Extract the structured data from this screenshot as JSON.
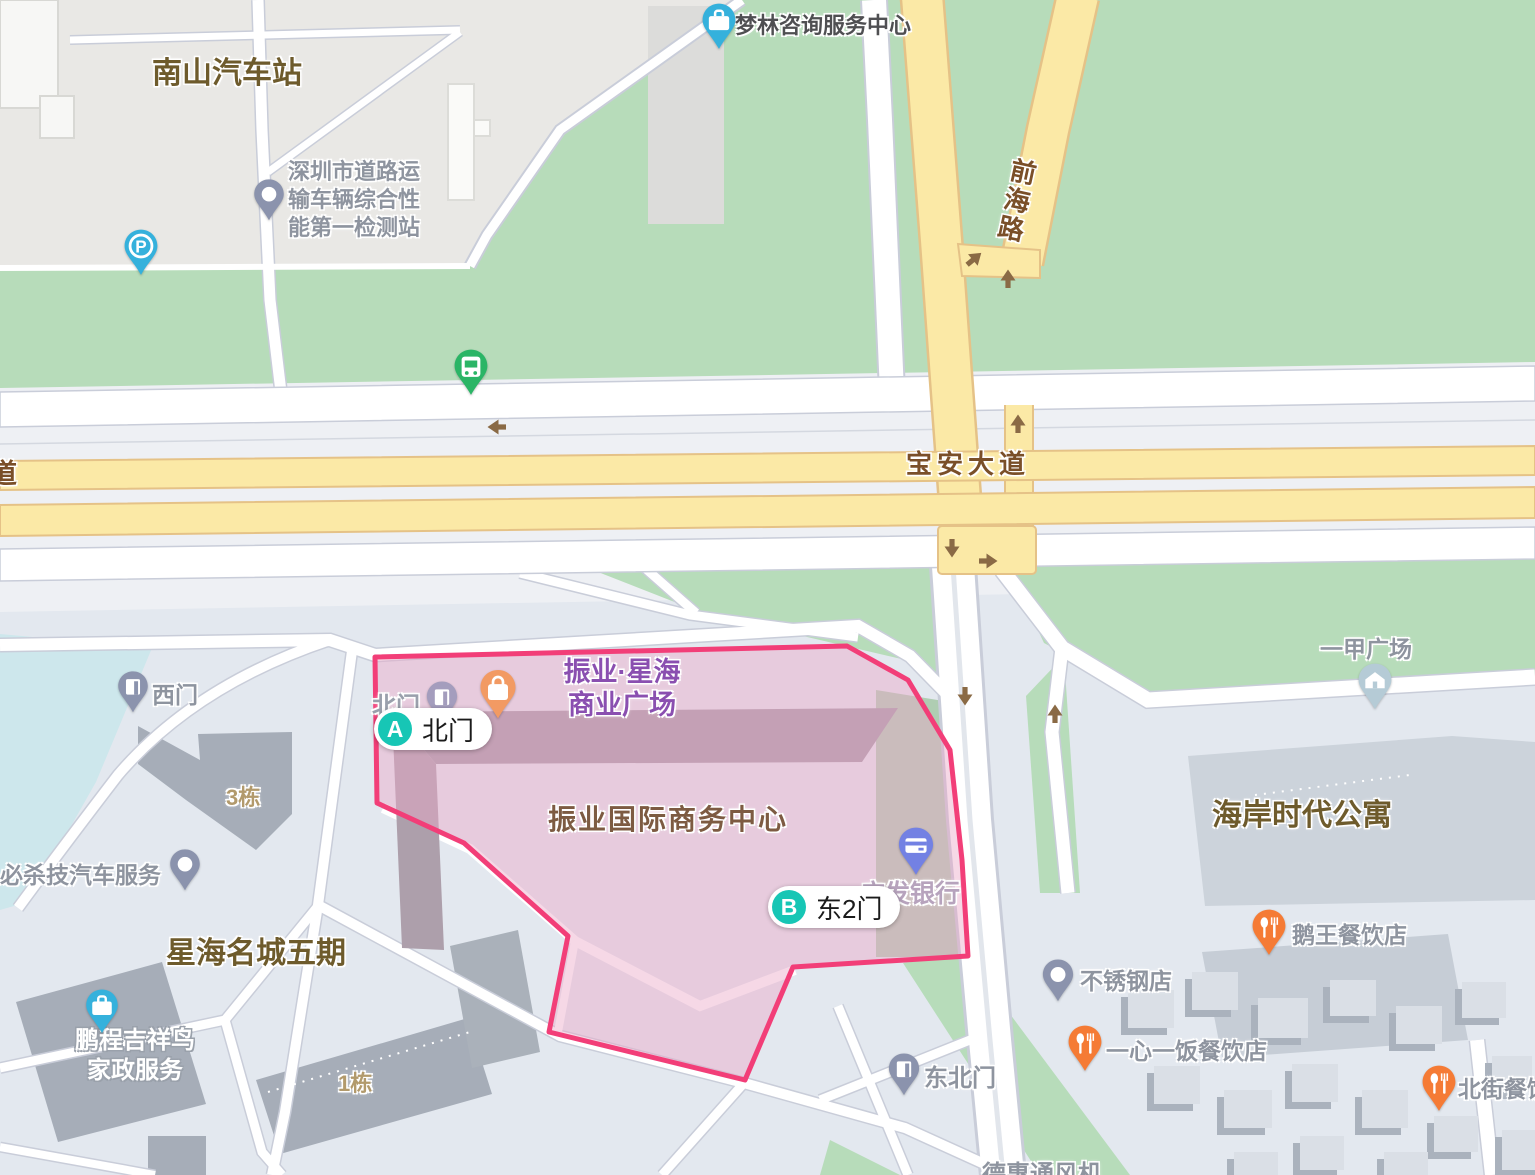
{
  "map": {
    "region_labels": {
      "nanshan_bus_station": "南山汽车站",
      "xinghai_mingcheng": "星海名城五期",
      "haian_apartment": "海岸时代公寓",
      "zhenye_center": "振业国际商务中心"
    },
    "road_labels": {
      "baoan_avenue": "宝安大道",
      "qianhai_road": "前海路",
      "dao_partial": "道"
    },
    "poi_labels": {
      "inspection_station": "深圳市道路运\n输车辆综合性\n能第一检测站",
      "menglin": "梦林咨询服务中心",
      "zhenye_plaza": "振业·星海\n商业广场",
      "beimen": "北门",
      "ximen": "西门",
      "dongbeimen": "东北门",
      "gf_bank": "广发银行",
      "yijia_plaza": "一甲广场",
      "ewang": "鹅王餐饮店",
      "buxiugang": "不锈钢店",
      "yixinyifan": "一心一饭餐饮店",
      "beijie": "北街餐饮店",
      "bishaji": "必杀技汽车服务",
      "pengcheng": "鹏程吉祥鸟\n家政服务",
      "dehuitong": "德惠通风机",
      "building_3": "3栋",
      "building_1": "1栋"
    },
    "markers": {
      "a": {
        "letter": "A",
        "label": "北门"
      },
      "b": {
        "letter": "B",
        "label": "东2门"
      },
      "parking_letter": "P"
    },
    "colors": {
      "highlight_border": "#f23e78",
      "highlight_fill": "rgba(234,169,199,0.45)",
      "marker_teal": "#17c6b5",
      "road_yellow": "#fbe9a6",
      "road_yellow_edge": "#e5c287",
      "green_area": "#b7dcba",
      "water": "#cde7ec",
      "poi_gray": "#8e949f",
      "area_label_brown": "#6e5b2c",
      "road_label_brown": "#7a4f28",
      "plaza_purple": "#8a4fb0",
      "restaurant_pin_orange": "#f57b35",
      "bag_pin_orange": "#f29a63",
      "briefcase_pin_blue": "#35b1dc",
      "gate_pin_slate": "#8b93ad",
      "bank_pin_indigo": "#7381e3",
      "bus_pin_green": "#2bb566",
      "house_pin_blue": "#b5cbd6",
      "arrow_brown": "#8a6a45",
      "bank_text": "#b7a3bd",
      "building_number_tan": "#b29a6c"
    }
  }
}
